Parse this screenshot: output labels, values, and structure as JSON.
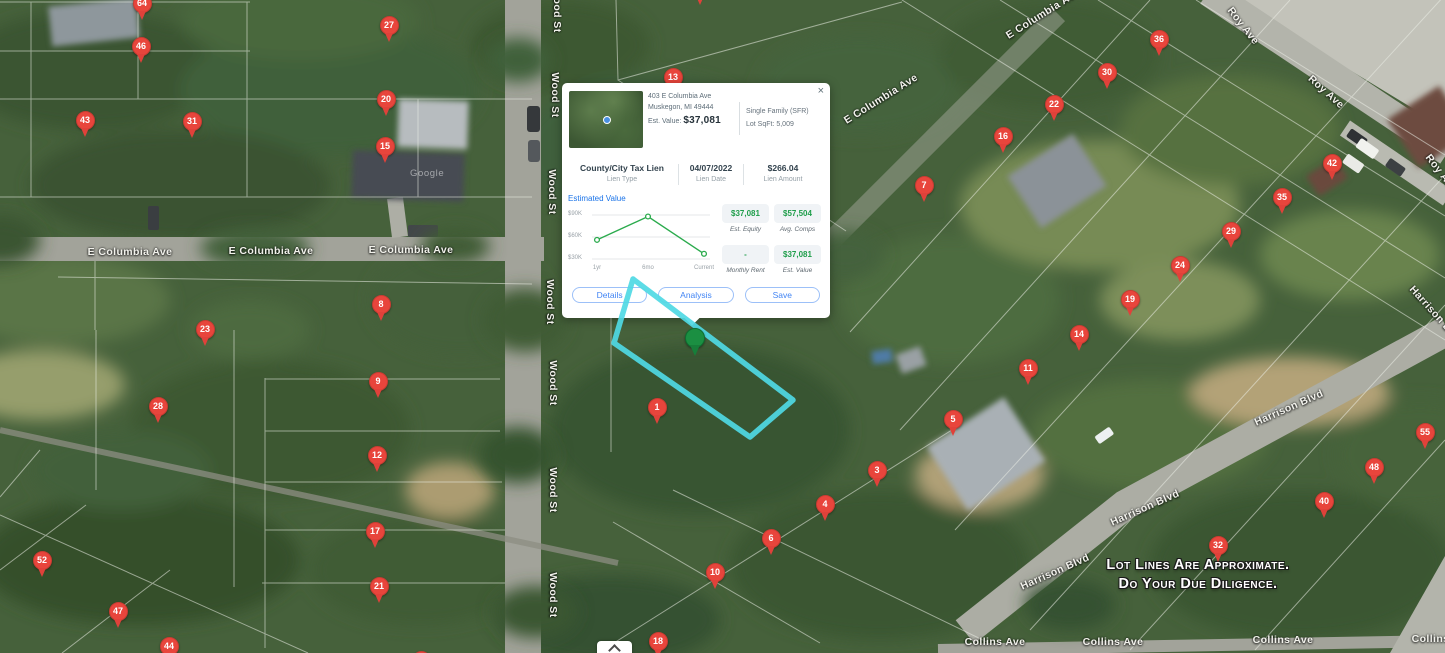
{
  "app": {
    "watermark": "Google"
  },
  "popup": {
    "close_label": "×",
    "address_line1": "403 E Columbia Ave",
    "address_line2": "Muskegon, MI 49444",
    "est_value_label": "Est. Value:",
    "est_value": "$37,081",
    "property_type": "Single Family (SFR)",
    "lot_sqft": "Lot SqFt: 5,009",
    "lien": {
      "type_value": "County/City Tax Lien",
      "type_label": "Lien Type",
      "date_value": "04/07/2022",
      "date_label": "Lien Date",
      "amount_value": "$266.04",
      "amount_label": "Lien Amount"
    },
    "chart": {
      "type": "line",
      "title": "Estimated Value",
      "x": [
        "1yr",
        "6mo",
        "Current"
      ],
      "values": [
        56000,
        88000,
        37081
      ],
      "yticks": [
        {
          "label": "$90K",
          "value": 90000
        },
        {
          "label": "$60K",
          "value": 60000
        },
        {
          "label": "$30K",
          "value": 30000
        }
      ],
      "ylim": [
        25000,
        95000
      ],
      "line_color": "#2bab4d",
      "grid": true,
      "legend": "none"
    },
    "stats": [
      {
        "value": "$37,081",
        "label": "Est. Equity"
      },
      {
        "value": "$57,504",
        "label": "Avg. Comps"
      },
      {
        "value": "-",
        "label": "Monthly Rent"
      },
      {
        "value": "$37,081",
        "label": "Est. Value"
      }
    ],
    "buttons": [
      "Details",
      "Analysis",
      "Save"
    ]
  },
  "map": {
    "disclaimer_line1": "Lot Lines Are Approximate.",
    "disclaimer_line2": "Do Your Due Diligence.",
    "green_pin": {
      "x": 695,
      "y": 338
    },
    "pins": [
      {
        "n": "64",
        "x": 142,
        "y": 3
      },
      {
        "n": "46",
        "x": 141,
        "y": 46
      },
      {
        "n": "27",
        "x": 389,
        "y": 25
      },
      {
        "n": "43",
        "x": 85,
        "y": 120
      },
      {
        "n": "31",
        "x": 192,
        "y": 121
      },
      {
        "n": "20",
        "x": 386,
        "y": 99
      },
      {
        "n": "15",
        "x": 385,
        "y": 146
      },
      {
        "n": "13",
        "x": 673,
        "y": 77
      },
      {
        "n": "",
        "x": 700,
        "y": -12
      },
      {
        "n": "36",
        "x": 1159,
        "y": 39
      },
      {
        "n": "30",
        "x": 1107,
        "y": 72
      },
      {
        "n": "22",
        "x": 1054,
        "y": 104
      },
      {
        "n": "16",
        "x": 1003,
        "y": 136
      },
      {
        "n": "7",
        "x": 924,
        "y": 185
      },
      {
        "n": "42",
        "x": 1332,
        "y": 163
      },
      {
        "n": "35",
        "x": 1282,
        "y": 197
      },
      {
        "n": "29",
        "x": 1231,
        "y": 231
      },
      {
        "n": "24",
        "x": 1180,
        "y": 265
      },
      {
        "n": "19",
        "x": 1130,
        "y": 299
      },
      {
        "n": "8",
        "x": 381,
        "y": 304
      },
      {
        "n": "23",
        "x": 205,
        "y": 329
      },
      {
        "n": "14",
        "x": 1079,
        "y": 334
      },
      {
        "n": "11",
        "x": 1028,
        "y": 368
      },
      {
        "n": "9",
        "x": 378,
        "y": 381
      },
      {
        "n": "28",
        "x": 158,
        "y": 406
      },
      {
        "n": "1",
        "x": 657,
        "y": 407
      },
      {
        "n": "5",
        "x": 953,
        "y": 419
      },
      {
        "n": "55",
        "x": 1425,
        "y": 432
      },
      {
        "n": "12",
        "x": 377,
        "y": 455
      },
      {
        "n": "48",
        "x": 1374,
        "y": 467
      },
      {
        "n": "3",
        "x": 877,
        "y": 470
      },
      {
        "n": "40",
        "x": 1324,
        "y": 501
      },
      {
        "n": "4",
        "x": 825,
        "y": 504
      },
      {
        "n": "17",
        "x": 375,
        "y": 531
      },
      {
        "n": "6",
        "x": 771,
        "y": 538
      },
      {
        "n": "32",
        "x": 1218,
        "y": 545
      },
      {
        "n": "52",
        "x": 42,
        "y": 560
      },
      {
        "n": "10",
        "x": 715,
        "y": 572
      },
      {
        "n": "21",
        "x": 379,
        "y": 586
      },
      {
        "n": "47",
        "x": 118,
        "y": 611
      },
      {
        "n": "18",
        "x": 658,
        "y": 641
      },
      {
        "n": "44",
        "x": 169,
        "y": 646
      },
      {
        "n": "",
        "x": 421,
        "y": 660
      }
    ],
    "street_labels": [
      {
        "text": "E Columbia Ave",
        "x": 130,
        "y": 252,
        "rot": 0
      },
      {
        "text": "E Columbia Ave",
        "x": 271,
        "y": 251,
        "rot": 0
      },
      {
        "text": "E Columbia Ave",
        "x": 411,
        "y": 250,
        "rot": 0
      },
      {
        "text": "E Columbia Ave",
        "x": 881,
        "y": 99,
        "rot": -32
      },
      {
        "text": "E Columbia Ave",
        "x": 1043,
        "y": 14,
        "rot": -32
      },
      {
        "text": "Wood St",
        "x": 557,
        "y": 10,
        "rot": 90
      },
      {
        "text": "Wood St",
        "x": 555,
        "y": 95,
        "rot": 90
      },
      {
        "text": "Wood St",
        "x": 552,
        "y": 192,
        "rot": 90
      },
      {
        "text": "Wood St",
        "x": 550,
        "y": 302,
        "rot": 90
      },
      {
        "text": "Wood St",
        "x": 553,
        "y": 383,
        "rot": 90
      },
      {
        "text": "Wood St",
        "x": 553,
        "y": 490,
        "rot": 90
      },
      {
        "text": "Wood St",
        "x": 553,
        "y": 595,
        "rot": 90
      },
      {
        "text": "Roy Ave",
        "x": 1243,
        "y": 26,
        "rot": 52
      },
      {
        "text": "Roy Ave",
        "x": 1326,
        "y": 92,
        "rot": 42
      },
      {
        "text": "Roy Ave",
        "x": 1441,
        "y": 173,
        "rot": 52
      },
      {
        "text": "Harrison Blvd",
        "x": 1289,
        "y": 408,
        "rot": -24
      },
      {
        "text": "Harrison Blvd",
        "x": 1145,
        "y": 508,
        "rot": -24
      },
      {
        "text": "Harrison Blvd",
        "x": 1055,
        "y": 572,
        "rot": -24
      },
      {
        "text": "Harrison Blvd",
        "x": 1436,
        "y": 315,
        "rot": 48
      },
      {
        "text": "Collins Ave",
        "x": 995,
        "y": 642,
        "rot": 0
      },
      {
        "text": "Collins Ave",
        "x": 1113,
        "y": 642,
        "rot": 0
      },
      {
        "text": "Collins Ave",
        "x": 1283,
        "y": 640,
        "rot": 0
      },
      {
        "text": "Collins Ave",
        "x": 1442,
        "y": 639,
        "rot": 0
      }
    ]
  },
  "controls": {
    "collapse_button_icon": "chevron-up"
  }
}
